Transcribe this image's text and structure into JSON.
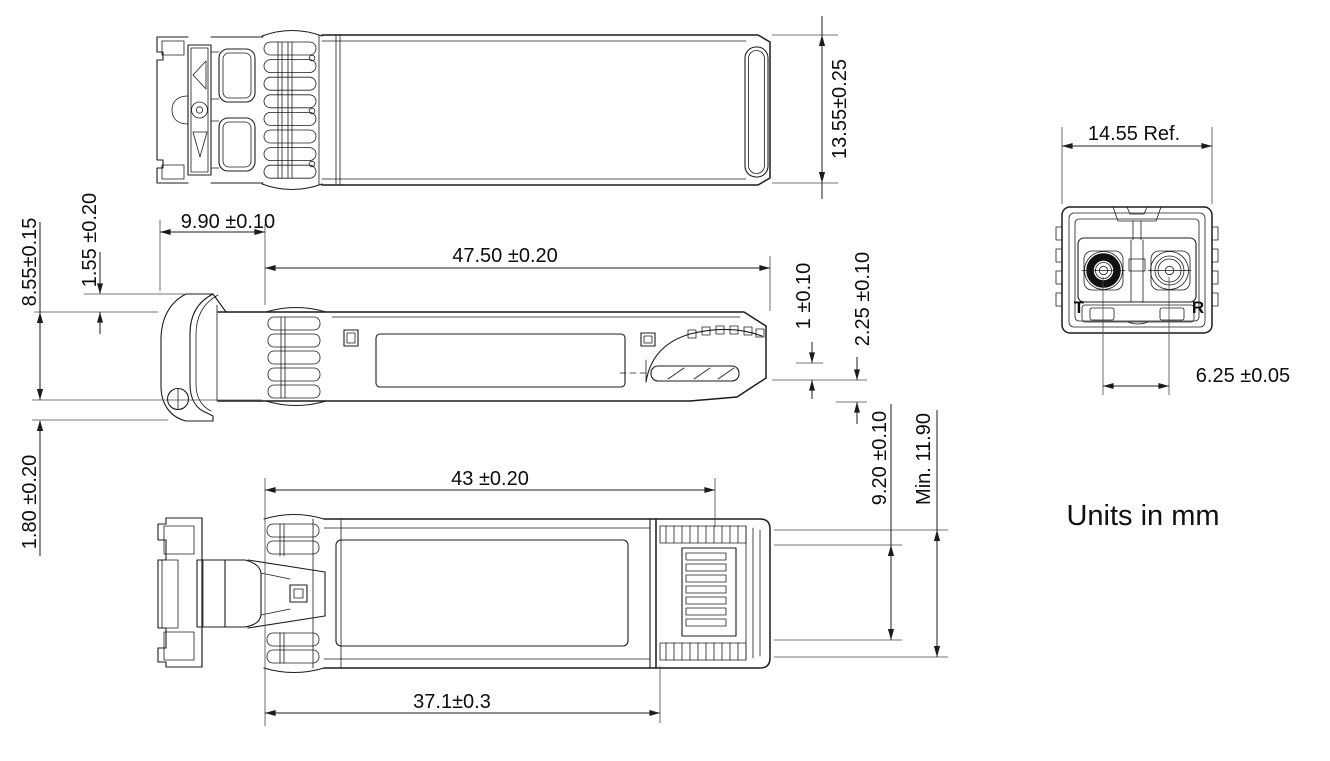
{
  "colors": {
    "line": "#1c1c1c",
    "background": "#ffffff"
  },
  "note": {
    "units": "Units in mm"
  },
  "dims": {
    "top_height": "13.55±0.25",
    "nose_length": "9.90 ±0.10",
    "cage_length": "47.50 ±0.20",
    "bail_above_body": "1.55 ±0.20",
    "body_height": "8.55±0.15",
    "bail_below_body": "1.80 ±0.20",
    "end_step": "1 ±0.10",
    "end_tail": "2.25 ±0.10",
    "conn_length": "43 ±0.20",
    "finger_length": "37.1±0.3",
    "conn_inner_height": "9.20 ±0.10",
    "conn_outer_height": "Min. 11.90",
    "front_width": "14.55 Ref.",
    "port_pitch": "6.25 ±0.05"
  },
  "front": {
    "tx_label": "T",
    "rx_label": "R"
  }
}
